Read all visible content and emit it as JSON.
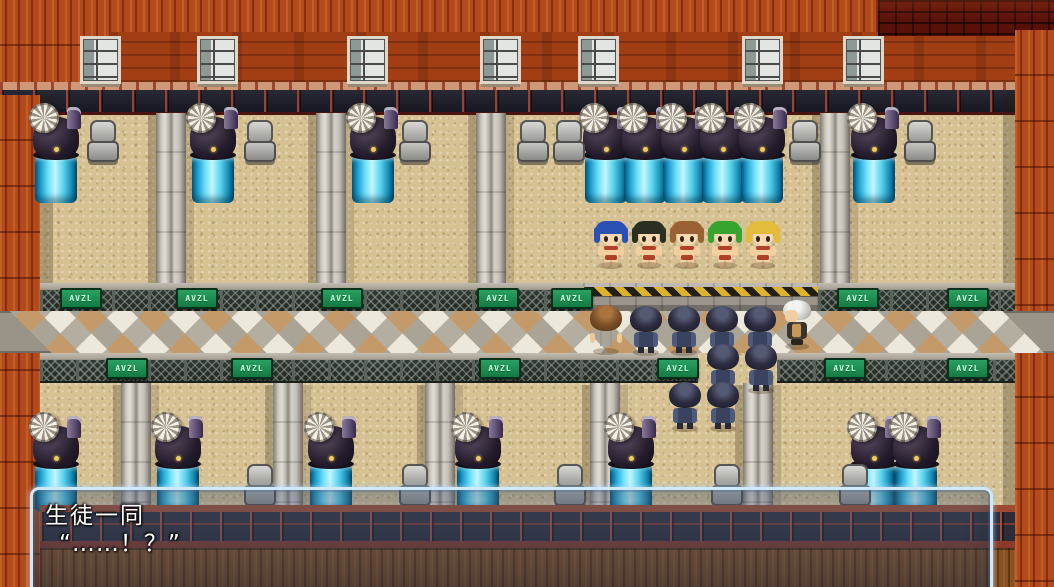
{
  "dialogue": {
    "speaker": "生徒一同",
    "line": "“……！？”"
  },
  "sign_label": "AVZL",
  "colors": {
    "window_border": "#cfe9fb",
    "hazard_yellow": "#ddb32c",
    "sign_green": "#1f8a50",
    "tank_cyan": "#6ee0fa",
    "brick_orange": "#b24a1c",
    "brick_maroon": "#571109"
  },
  "scene": {
    "windows": {
      "y": 36,
      "xs": [
        80,
        197,
        347,
        480,
        578,
        742,
        843
      ]
    },
    "upper_pillars": {
      "y": 113,
      "h": 172,
      "xs": [
        156,
        316,
        476,
        820
      ]
    },
    "upper_machines": {
      "y": 111,
      "xs": [
        33,
        190,
        350,
        583,
        622,
        661,
        700,
        739,
        851
      ]
    },
    "upper_chairs": {
      "y": 120,
      "xs": [
        86,
        243,
        398,
        516,
        552,
        788,
        903
      ]
    },
    "upper_rails": {
      "y": 283,
      "segs": [
        [
          40,
          583
        ],
        [
          818,
          1015
        ]
      ]
    },
    "hazard": {
      "x": 583,
      "y": 283,
      "w": 235
    },
    "upper_signs": {
      "y": 288,
      "xs": [
        60,
        176,
        321,
        477,
        551,
        837,
        947
      ]
    },
    "walkway": {
      "y": 311,
      "h": 42
    },
    "lower_rails": {
      "y": 353,
      "segs": [
        [
          40,
          698
        ],
        [
          777,
          1015
        ]
      ]
    },
    "lower_signs": {
      "y": 358,
      "xs": [
        106,
        231,
        479,
        657,
        824,
        947
      ]
    },
    "lower_pillars": {
      "y": 383,
      "h": 122,
      "xs": [
        121,
        273,
        425,
        590,
        743
      ]
    },
    "lower_machines": {
      "y": 420,
      "xs": [
        33,
        155,
        308,
        455,
        608,
        851,
        893
      ]
    },
    "lower_chairs": {
      "y": 464,
      "xs": [
        243,
        398,
        553,
        710,
        838
      ]
    },
    "girls": {
      "y": 221,
      "list": [
        {
          "x": 594,
          "hair": "#2a50b4"
        },
        {
          "x": 632,
          "hair": "#2a2f22"
        },
        {
          "x": 670,
          "hair": "#9a6234"
        },
        {
          "x": 708,
          "hair": "#38a430"
        },
        {
          "x": 746,
          "hair": "#e4bc3c"
        }
      ]
    },
    "boy": {
      "x": 588,
      "y": 305
    },
    "old_man": {
      "x": 780,
      "y": 300
    },
    "students": [
      {
        "x": 628,
        "y": 306
      },
      {
        "x": 666,
        "y": 306
      },
      {
        "x": 704,
        "y": 306
      },
      {
        "x": 742,
        "y": 306
      },
      {
        "x": 705,
        "y": 344
      },
      {
        "x": 743,
        "y": 344
      },
      {
        "x": 667,
        "y": 382
      },
      {
        "x": 705,
        "y": 382
      }
    ]
  }
}
